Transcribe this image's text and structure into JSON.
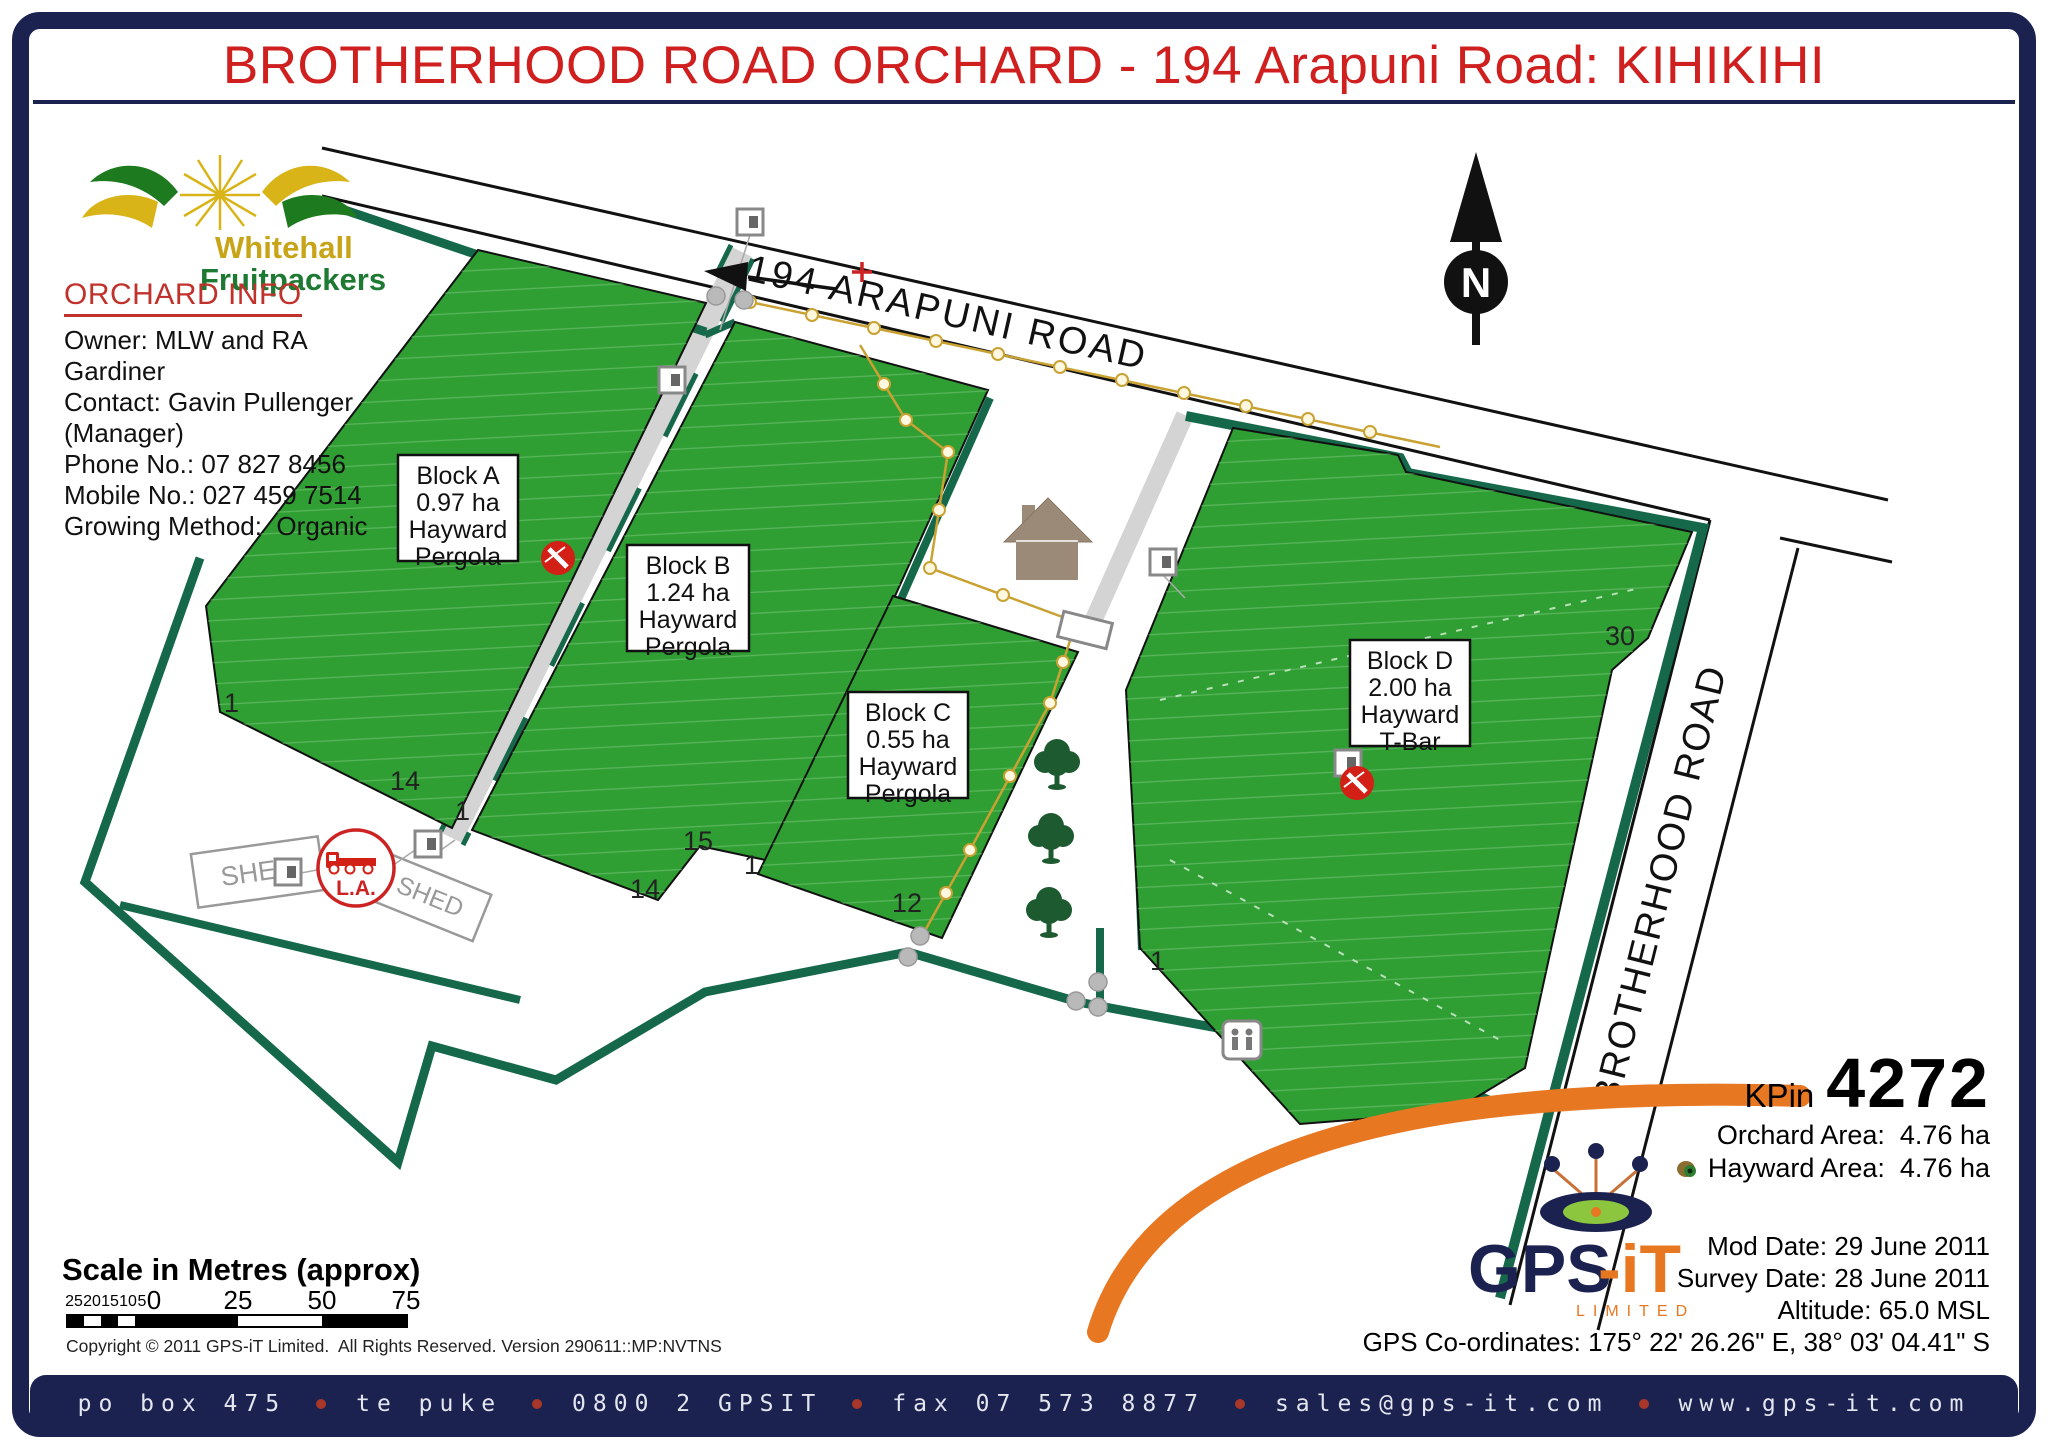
{
  "title": "BROTHERHOOD ROAD ORCHARD - 194 Arapuni Road: KIHIKIHI",
  "logo": {
    "line1": "Whitehall",
    "line2": "Fruitpackers"
  },
  "orchard_info": {
    "heading": "ORCHARD INFO",
    "owner": "Owner: MLW and RA Gardiner",
    "contact": "Contact: Gavin Pullenger (Manager)",
    "phone": "Phone No.: 07 827 8456",
    "mobile": "Mobile No.: 027 459 7514",
    "growing": "Growing Method:  Organic"
  },
  "map": {
    "north_label": "N",
    "roads": {
      "arapuni": "194 ARAPUNI ROAD",
      "brotherhood": "BROTHERHOOD ROAD"
    },
    "blocks": [
      {
        "name": "Block A",
        "area": "0.97 ha",
        "variety": "Hayward",
        "structure": "Pergola"
      },
      {
        "name": "Block B",
        "area": "1.24 ha",
        "variety": "Hayward",
        "structure": "Pergola"
      },
      {
        "name": "Block C",
        "area": "0.55 ha",
        "variety": "Hayward",
        "structure": "Pergola"
      },
      {
        "name": "Block D",
        "area": "2.00 ha",
        "variety": "Hayward",
        "structure": "T-Bar"
      }
    ],
    "sheds": [
      "SHED",
      "SHED"
    ],
    "load_area_label": "L.A.",
    "row_numbers": [
      "1",
      "14",
      "1",
      "15",
      "14",
      "1",
      "12",
      "1",
      "30"
    ]
  },
  "scale": {
    "title": "Scale in Metres (approx)",
    "minor_ticks": [
      "25",
      "20",
      "15",
      "10",
      "5"
    ],
    "major_ticks": [
      "0",
      "25",
      "50",
      "75"
    ]
  },
  "copyright": "Copyright © 2011 GPS-iT Limited.  All Rights Reserved. Version 290611::MP:NVTNS",
  "summary": {
    "kpin_label": "KPin",
    "kpin": "4272",
    "orchard_area": "Orchard Area:  4.76 ha",
    "hayward_area": "Hayward Area:  4.76 ha"
  },
  "survey": {
    "mod_date": "Mod Date: 29 June 2011",
    "survey_date": "Survey Date: 28 June 2011",
    "altitude": "Altitude: 65.0 MSL",
    "gps": "GPS Co-ordinates: 175° 22' 26.26\" E, 38° 03' 04.41\" S"
  },
  "gpsit_logo": {
    "gps": "GPS",
    "it": "-iT",
    "limited": "LIMITED"
  },
  "footer": {
    "items": [
      "po box 475",
      "te puke",
      "0800 2 GPSIT",
      "fax 07 573 8877",
      "sales@gps-it.com",
      "www.gps-it.com"
    ]
  },
  "colors": {
    "navy": "#1b2250",
    "title_red": "#cf1f1f",
    "block_green": "#2f9e33",
    "boundary_green": "#15694a",
    "fence_yellow": "#c9a233",
    "track_gray": "#d4d4d4",
    "orange": "#e87722"
  }
}
